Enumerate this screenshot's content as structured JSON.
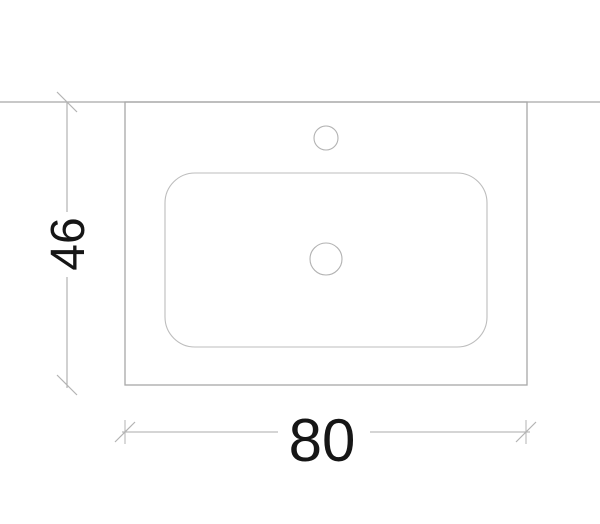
{
  "drawing": {
    "dimensions": {
      "width_label": "80",
      "height_label": "46"
    },
    "colors": {
      "background": "#ffffff",
      "outline": "#a8a8a8",
      "inner_outline": "#bdbdbd",
      "hole_outline": "#b2b2b2",
      "dimension_line": "#ababab",
      "tick": "#b3b3b3",
      "text": "#161616"
    }
  }
}
